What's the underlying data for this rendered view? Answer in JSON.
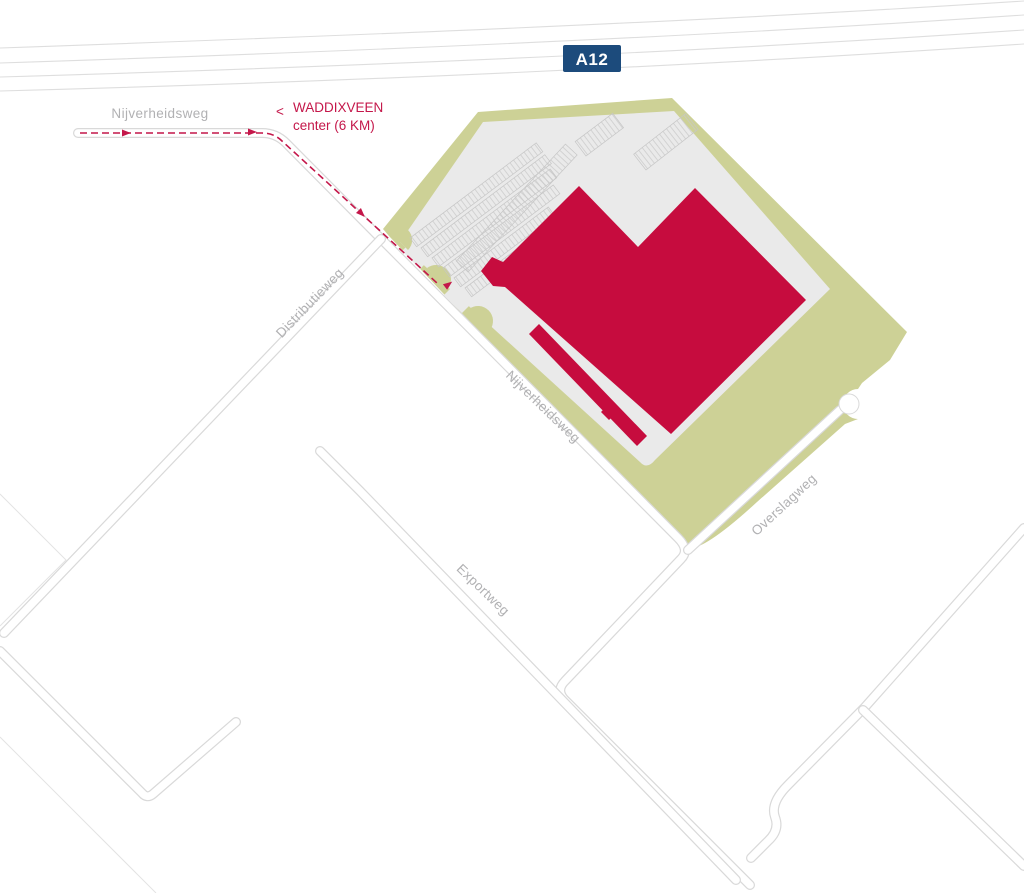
{
  "map": {
    "highway_badge": "A12",
    "destination": {
      "arrow": "<",
      "line1": "WADDIXVEEN",
      "line2": "center (6 KM)"
    },
    "road_labels": {
      "nijverheidsweg_west": "Nijverheidsweg",
      "nijverheidsweg_site": "Nijverheidsweg",
      "distributieweg": "Distributieweg",
      "exportweg": "Exportweg",
      "overslagweg": "Overslagweg"
    },
    "colors": {
      "building": "#c60c3e",
      "green_area": "#cdd196",
      "pavement": "#eaeaea",
      "route": "#c4174a",
      "badge_bg": "#1c4b7c",
      "badge_text": "#ffffff",
      "road_label": "#b1b1b3"
    }
  }
}
